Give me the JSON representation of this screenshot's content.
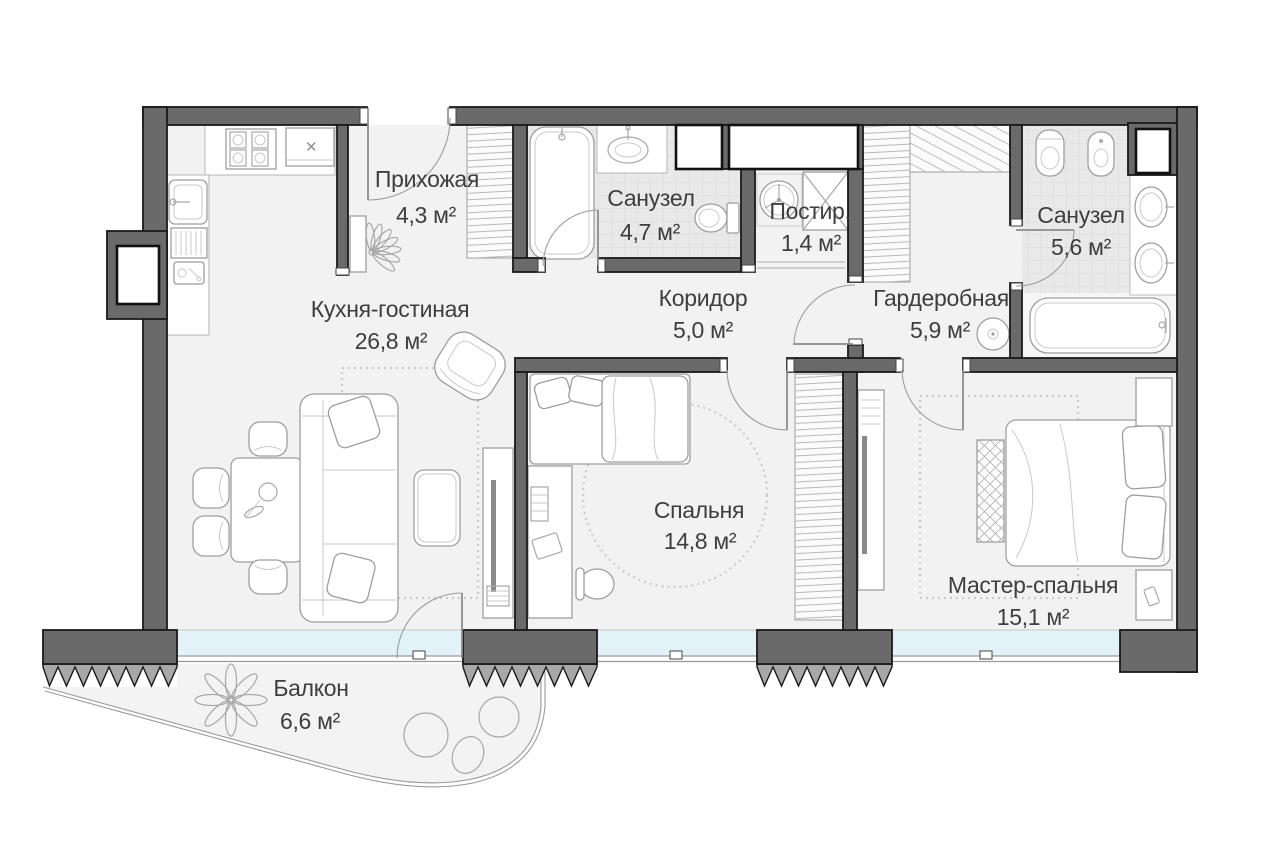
{
  "plan": {
    "type": "apartment-floor-plan",
    "language": "ru",
    "rooms": [
      {
        "id": "hallway",
        "name": "Прихожая",
        "area": "4,3 м²"
      },
      {
        "id": "bathroom-1",
        "name": "Санузел",
        "area": "4,7 м²"
      },
      {
        "id": "laundry",
        "name": "Постир.",
        "area": "1,4 м²"
      },
      {
        "id": "bathroom-2",
        "name": "Санузел",
        "area": "5,6 м²"
      },
      {
        "id": "kitchen-living",
        "name": "Кухня-гостиная",
        "area": "26,8 м²"
      },
      {
        "id": "corridor",
        "name": "Коридор",
        "area": "5,0 м²"
      },
      {
        "id": "wardrobe",
        "name": "Гардеробная",
        "area": "5,9 м²"
      },
      {
        "id": "bedroom",
        "name": "Спальня",
        "area": "14,8 м²"
      },
      {
        "id": "master-bedroom",
        "name": "Мастер-спальня",
        "area": "15,1 м²"
      },
      {
        "id": "balcony",
        "name": "Балкон",
        "area": "6,6 м²"
      }
    ],
    "icons": {
      "hood_cross": "✕"
    },
    "colors": {
      "wall": "#6a6a6a",
      "wall_outline": "#1a1a1a",
      "floor": "#f2f2f2",
      "tile_floor": "#e9e9e9",
      "glazing": "#e3f1f9",
      "pier_hatch": "#a8a8a8",
      "furniture_line": "#9e9e9e",
      "label_text": "#3e3e3e"
    }
  }
}
